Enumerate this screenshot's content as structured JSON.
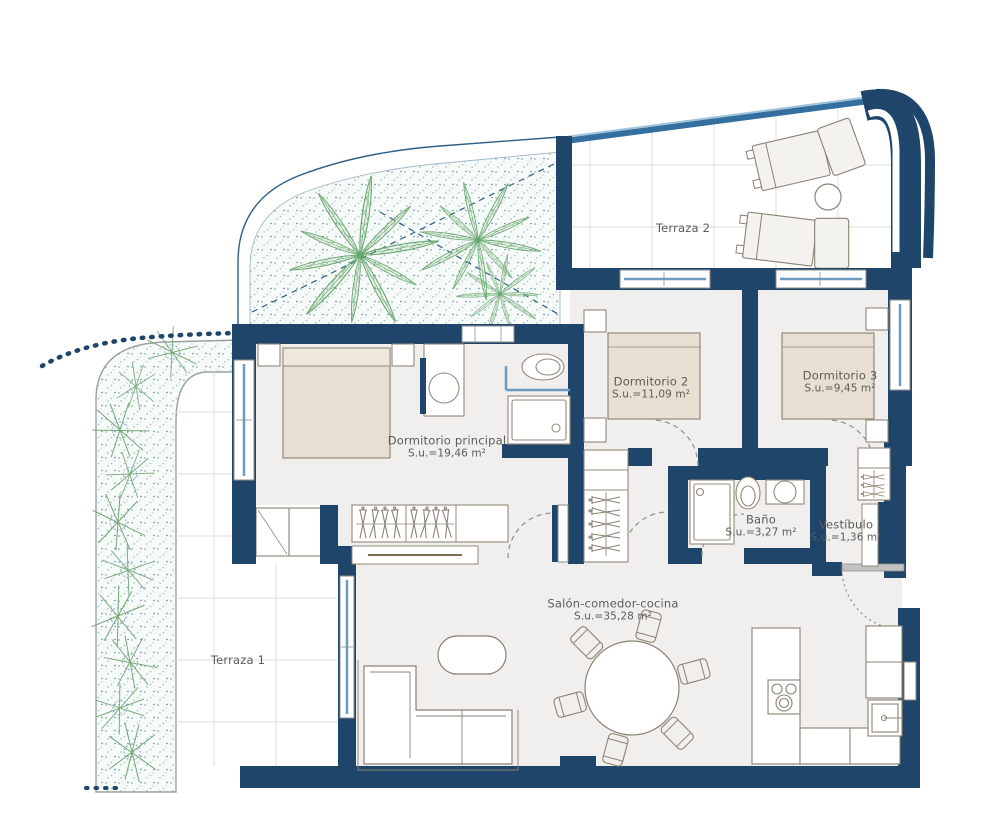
{
  "rooms": {
    "terraza2": {
      "label": "Terraza 2"
    },
    "dormitorio2": {
      "label": "Dormitorio 2",
      "area": "S.u.=11,09 m²"
    },
    "dormitorio3": {
      "label": "Dormitorio 3",
      "area": "S.u.=9,45 m²"
    },
    "principal": {
      "label": "Dormitorio principal",
      "area": "S.u.=19,46 m²"
    },
    "bano": {
      "label": "Baño",
      "area": "S.u.=3,27 m²"
    },
    "vestibulo": {
      "label": "Vestíbulo",
      "area": "S.u.=1,36 m²"
    },
    "salon": {
      "label": "Salón-comedor-cocina",
      "area": "S.u.=35,28 m²"
    },
    "terraza1": {
      "label": "Terraza 1"
    }
  },
  "colors": {
    "wall": "#1f466a",
    "floor": "#f0efed",
    "furniture_fill": "#e7dfd2",
    "furniture_stroke": "#93897a",
    "glass": "#6d9cc0",
    "railing": "#4579a8",
    "tile_line": "#dcdcda",
    "plant_green": "#68a76e",
    "stipple_teal": "#8fb8a9",
    "label_text": "#5b5c57"
  },
  "symbols": {
    "palm_trees": 3,
    "sun_loungers": 2,
    "beds": 3,
    "dining_chairs": 6
  }
}
